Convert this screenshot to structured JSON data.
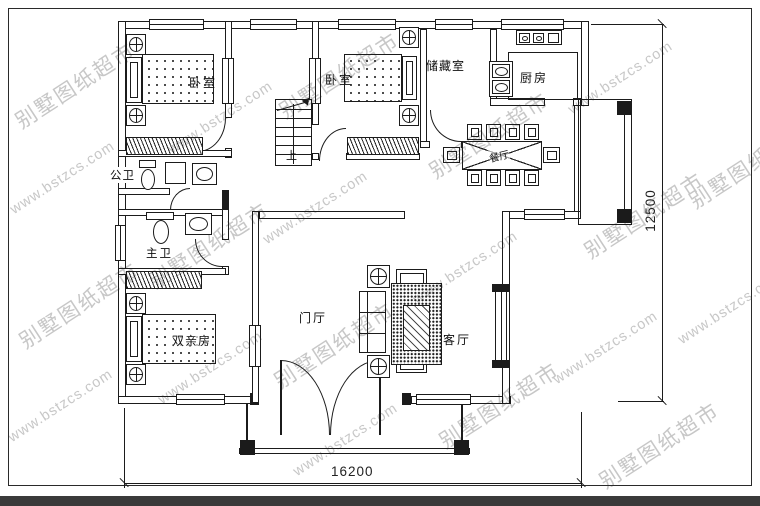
{
  "drawing": {
    "type": "floor-plan",
    "rooms": {
      "bedroom1": "卧室",
      "bedroom2": "卧室",
      "storage": "储藏室",
      "kitchen": "厨房",
      "public_bath": "公卫",
      "master_bath": "主卫",
      "parents_room": "双亲房",
      "foyer": "门厅",
      "living": "客厅",
      "dining": "餐厅",
      "stairs_up": "上"
    },
    "dimensions": {
      "width_mm": "16200",
      "height_mm": "12500"
    }
  },
  "watermark": {
    "cn": "别墅图纸超市",
    "url": "www.bstzcs.com"
  },
  "colors": {
    "line": "#1b1b1b",
    "watermark": "#c7c7c7",
    "paper": "#ffffff",
    "footer_bar": "#3a3a3a"
  }
}
